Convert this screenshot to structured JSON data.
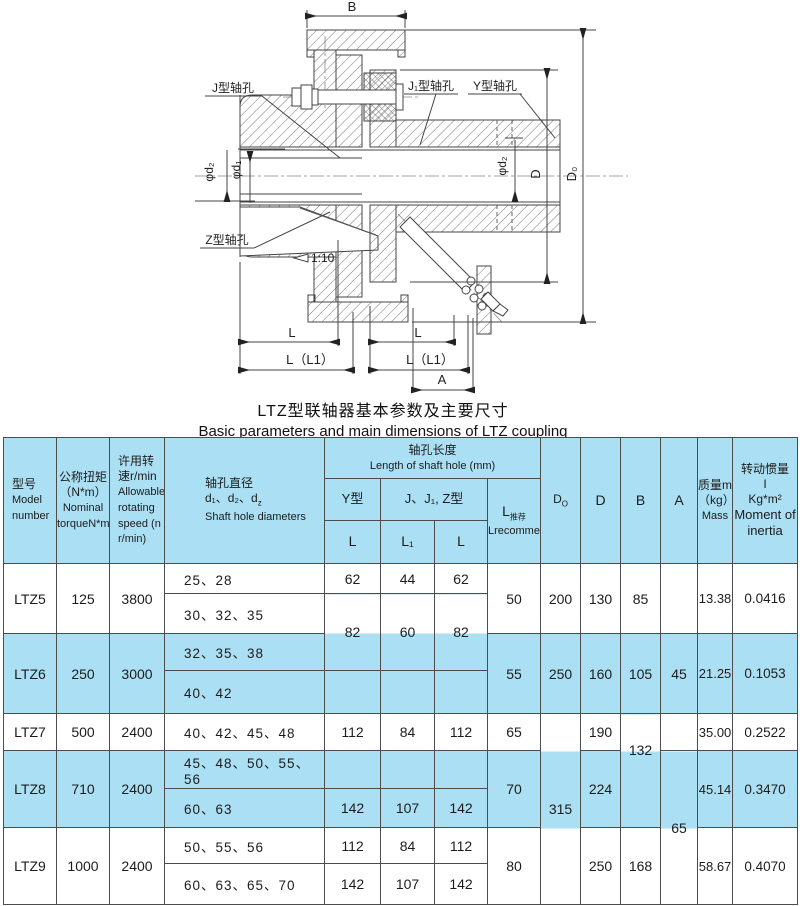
{
  "colors": {
    "highlight": "#abdff3",
    "line": "#444444",
    "border": "#4c4c4c"
  },
  "drawing": {
    "labels": {
      "b": "B",
      "j_hole": "J型轴孔",
      "j1_hole": "J₁型轴孔",
      "y_hole": "Y型轴孔",
      "z_hole": "Z型轴孔",
      "taper": "1:10",
      "phi_d2_left": "φd₂",
      "phi_d1": "φd₁",
      "phi_d2_right": "φd₂",
      "d": "D",
      "d0": "D₀",
      "l_left": "L",
      "l_right": "L",
      "ll1_left": "L（L1）",
      "ll1_right": "L（L1）",
      "a": "A"
    }
  },
  "title": {
    "zh": "LTZ型联轴器基本参数及主要尺寸",
    "en": "Basic parameters and main dimensions of LTZ coupling"
  },
  "table": {
    "header": {
      "model": {
        "zh": "型号",
        "en": "Model number"
      },
      "torque": {
        "zh": "公称扭矩",
        "unit": "（N*m）",
        "en": "Nominal torqueN*m"
      },
      "speed": {
        "zh": "许用转速r/min",
        "en": "Allowable rotating speed (n r/min)"
      },
      "dia": {
        "zh": "轴孔直径",
        "d": "d₁、d₂、d",
        "dsub": "z",
        "en": "Shaft hole diameters"
      },
      "len": {
        "zh": "轴孔长度",
        "en": "Length of shaft hole (mm)",
        "y": "Y型",
        "jz": "J、J₁, Z型",
        "l": "L",
        "l1": "L₁",
        "lz": "L"
      },
      "lrec": {
        "main": "L",
        "sub": "推荐",
        "en": "Lrecommend"
      },
      "d0": {
        "main": "D",
        "sub": "O"
      },
      "d": "D",
      "b": "B",
      "a": "A",
      "mass": {
        "zh": "质量m",
        "unit": "（kg）",
        "en": "Mass"
      },
      "inertia": {
        "zh": "转动惯量",
        "sym": "I",
        "unit": "Kg*m²",
        "en": "Moment of inertia"
      }
    },
    "groups": [
      {
        "model": "LTZ5",
        "torque": "125",
        "speed": "3800",
        "sub": [
          {
            "holes": "25、28",
            "L": "62",
            "L1": "44",
            "LZ": "62"
          },
          {
            "holes": "30、32、35",
            "L": "82",
            "L1": "60",
            "LZ": "82"
          }
        ],
        "Lrec": "50",
        "D0": "200",
        "D": "130",
        "B": "85",
        "A": "",
        "mass": "13.38",
        "inertia": "0.0416"
      },
      {
        "model": "LTZ6",
        "torque": "250",
        "speed": "3000",
        "sub": [
          {
            "holes": "32、35、38"
          },
          {
            "holes": "40、42"
          }
        ],
        "Lrec": "55",
        "D0": "250",
        "D": "160",
        "B": "105",
        "A": "45",
        "mass": "21.25",
        "inertia": "0.1053"
      },
      {
        "model": "LTZ7",
        "torque": "500",
        "speed": "2400",
        "sub": [
          {
            "holes": "40、42、45、48",
            "L": "112",
            "L1": "84",
            "LZ": "112"
          }
        ],
        "Lrec": "65",
        "D0": "315",
        "D": "190",
        "B": "132",
        "A": "",
        "mass": "35.00",
        "inertia": "0.2522"
      },
      {
        "model": "LTZ8",
        "torque": "710",
        "speed": "2400",
        "sub": [
          {
            "holes": "45、48、50、55、56"
          },
          {
            "holes": "60、63",
            "L": "142",
            "L1": "107",
            "LZ": "142"
          }
        ],
        "Lrec": "70",
        "D0": "",
        "D": "224",
        "B": "",
        "A": "65",
        "mass": "45.14",
        "inertia": "0.3470"
      },
      {
        "model": "LTZ9",
        "torque": "1000",
        "speed": "2400",
        "sub": [
          {
            "holes": "50、55、56",
            "L": "112",
            "L1": "84",
            "LZ": "112"
          },
          {
            "holes": "60、63、65、70",
            "L": "142",
            "L1": "107",
            "LZ": "142"
          }
        ],
        "Lrec": "80",
        "D0": "",
        "D": "250",
        "B": "168",
        "A": "",
        "mass": "58.67",
        "inertia": "0.4070"
      }
    ]
  }
}
